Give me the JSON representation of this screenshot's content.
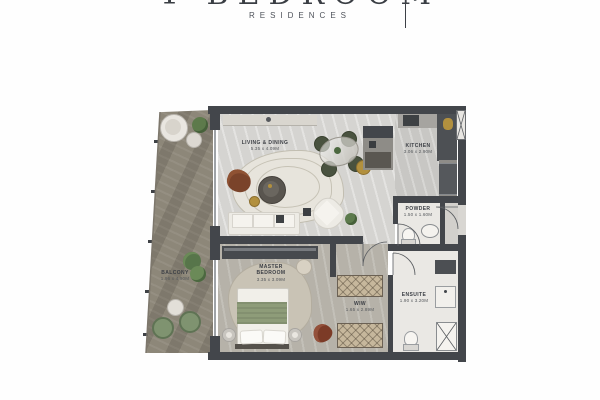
{
  "header": {
    "title": "1 BEDROOM",
    "subtitle": "RESIDENCES"
  },
  "floorplan": {
    "rooms": [
      {
        "id": "living",
        "label": "LIVING & DINING",
        "dims": "5.35 x 4.09M"
      },
      {
        "id": "kitchen",
        "label": "KITCHEN",
        "dims": "3.06 x 2.90M"
      },
      {
        "id": "powder",
        "label": "POWDER",
        "dims": "1.50 x 1.60M"
      },
      {
        "id": "master",
        "label": "MASTER BEDROOM",
        "dims": "3.35 x 3.09M"
      },
      {
        "id": "wiw",
        "label": "WIW",
        "dims": "1.65 x 2.89M"
      },
      {
        "id": "ensuite",
        "label": "ENSUITE",
        "dims": "1.90 x 3.20M"
      },
      {
        "id": "balcony",
        "label": "BALCONY",
        "dims": "1.96 x 4.90M"
      }
    ],
    "colors": {
      "wall": "#43464b",
      "living_floor": "#d5d4d1",
      "bedroom_floor": "#b6b2a9",
      "balcony_wood": "#8d8779",
      "bath_floor": "#eae8e4",
      "bed_throw_green": "#8e9c79",
      "leather_brown": "#7a432a",
      "accent_gold": "#b2903e",
      "plant_green": "#5d7a4b"
    }
  }
}
